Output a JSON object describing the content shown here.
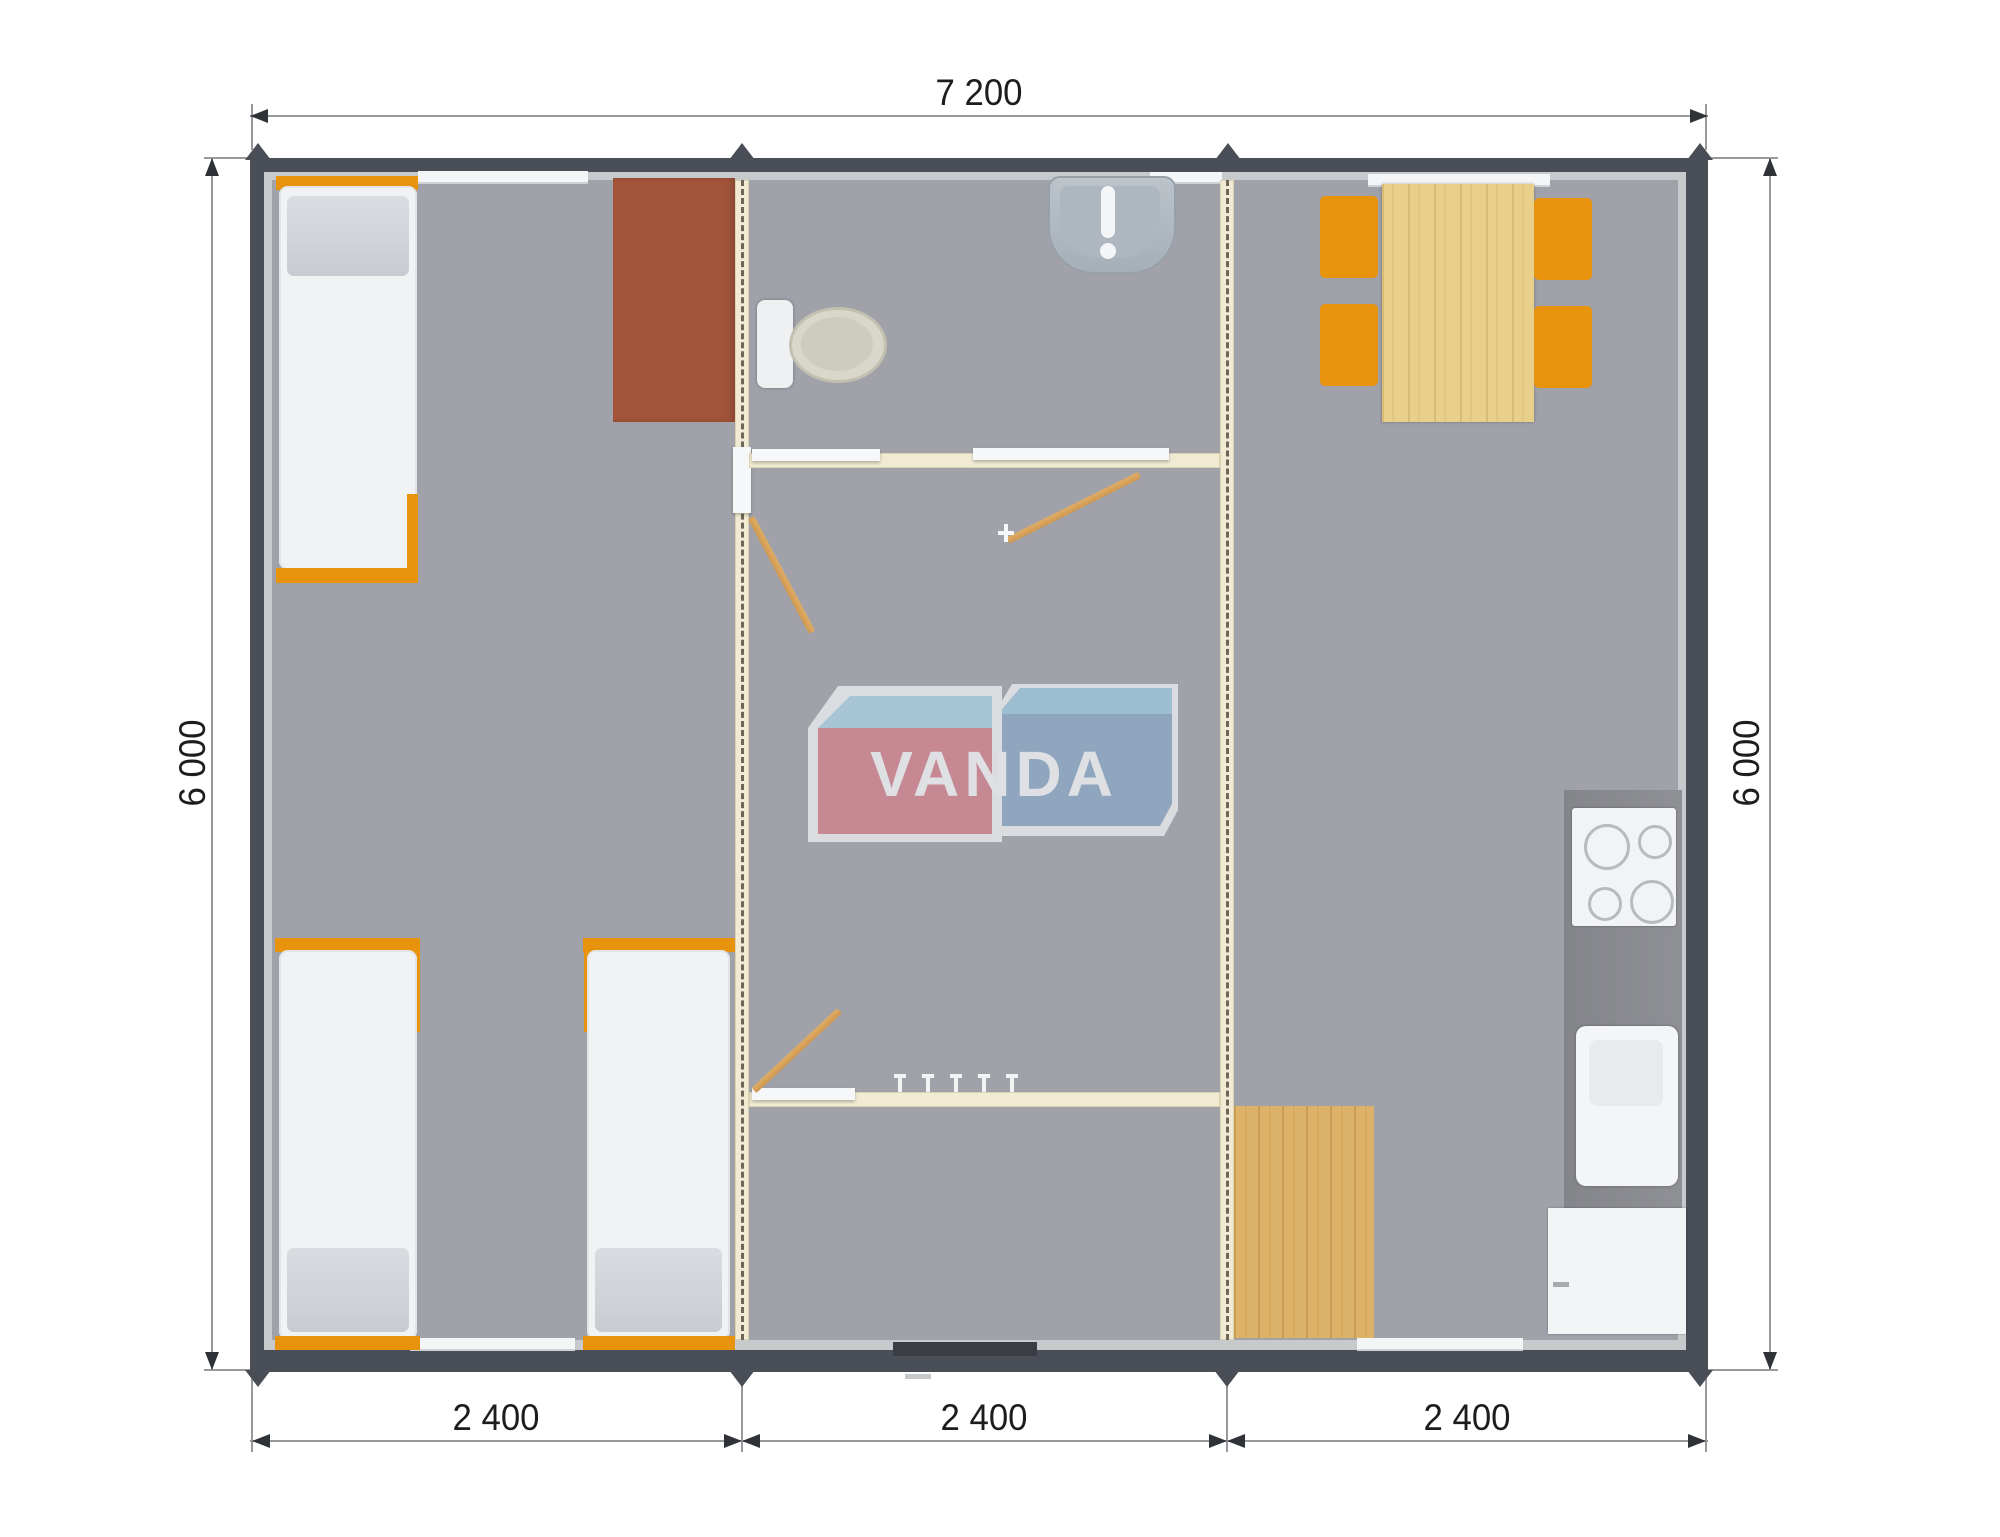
{
  "floor_plan": {
    "overall_width_label": "7 200",
    "overall_depth_label_left": "6 000",
    "overall_depth_label_right": "6 000",
    "module_width_labels": [
      "2 400",
      "2 400",
      "2 400"
    ]
  },
  "logo": {
    "text": "VANDA"
  },
  "colors": {
    "frame_dark": "#4a4f57",
    "inner_wall_light": "#c7cacc",
    "carpet_gray": "#a0a1a9",
    "partition_cream": "#f1ebd3",
    "accent_orange": "#e8930e",
    "wood": "#ddb369",
    "table_wood": "#e9d08a",
    "desk_brown": "#a3543a",
    "kitchen_counter": "#8a8b90",
    "logo_red": "#d0848e",
    "logo_blue": "#8da6c4",
    "logo_light_blue": "#a9cfe0"
  },
  "furniture_counts": {
    "single_beds": 3,
    "dining_chairs": 4,
    "cooktop_burners": 4,
    "coat_hooks": 5
  }
}
